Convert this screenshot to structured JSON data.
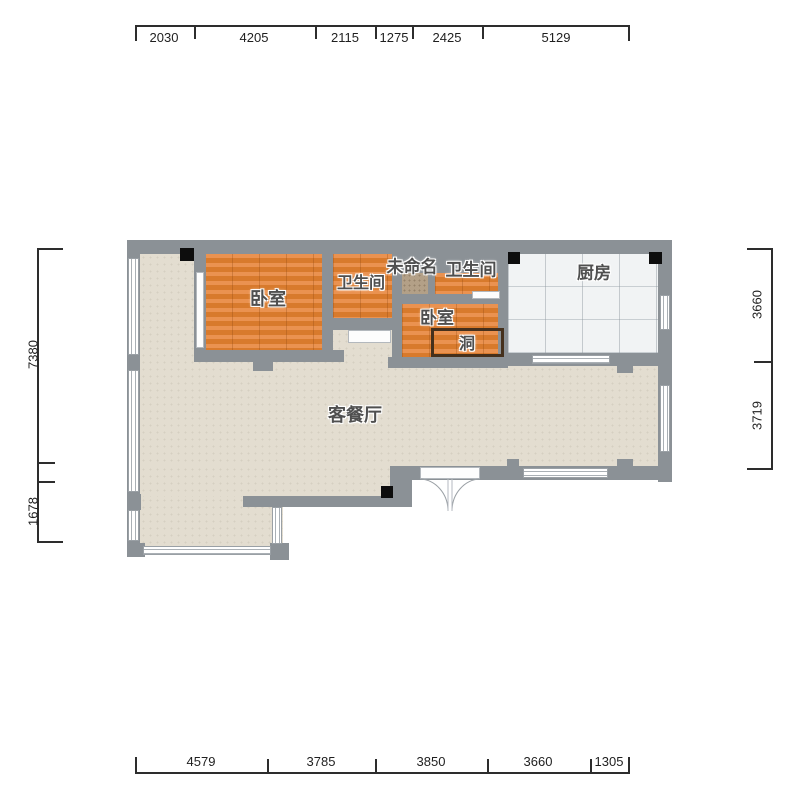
{
  "plan": {
    "rooms": [
      {
        "id": "bedroom-main",
        "label": "卧室"
      },
      {
        "id": "bathroom-1",
        "label": "卫生间"
      },
      {
        "id": "unnamed",
        "label": "未命名"
      },
      {
        "id": "bathroom-2",
        "label": "卫生间"
      },
      {
        "id": "kitchen",
        "label": "厨房"
      },
      {
        "id": "bedroom-small",
        "label": "卧室"
      },
      {
        "id": "opening",
        "label": "洞"
      },
      {
        "id": "living-dining",
        "label": "客餐厅"
      }
    ],
    "colors": {
      "wall": "#8b9196",
      "wood_floor": "#df8237",
      "living_floor": "#e3ddd0",
      "kitchen_floor": "#f1f3f4",
      "unnamed_floor": "#b3a087",
      "hole_outline": "#45301c",
      "dimension_text": "#1f1f1f"
    }
  },
  "dimensions": {
    "top": [
      "2030",
      "4205",
      "2115",
      "1275",
      "2425",
      "5129"
    ],
    "bottom": [
      "4579",
      "3785",
      "3850",
      "3660",
      "1305"
    ],
    "left": [
      "7380",
      "1678"
    ],
    "right": [
      "3660",
      "3719"
    ]
  }
}
